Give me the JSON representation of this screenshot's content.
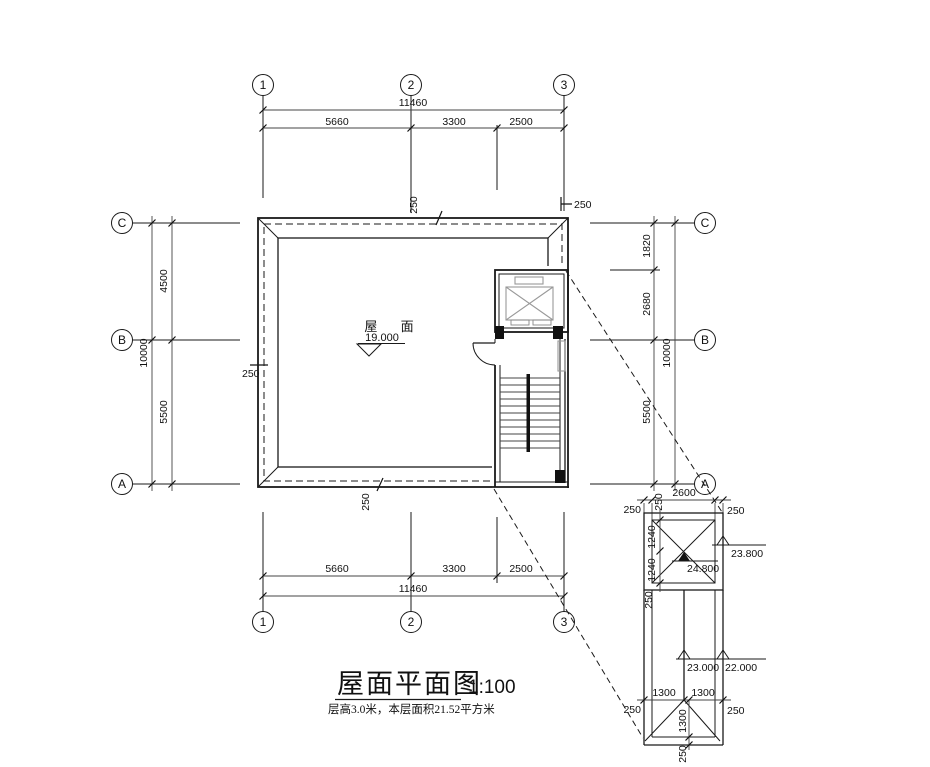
{
  "title_block": {
    "title": "屋面平面图",
    "scale": "1:100",
    "note": "层高3.0米，本层面积21.52平方米"
  },
  "roof": {
    "label": "屋 面",
    "level": "19.000"
  },
  "grid_bubbles": {
    "top": [
      "1",
      "2",
      "3"
    ],
    "bottom": [
      "1",
      "2",
      "3"
    ],
    "left": [
      "C",
      "B",
      "A"
    ],
    "right": [
      "C",
      "B",
      "A"
    ]
  },
  "dimensions": {
    "top": {
      "overall": "11460",
      "seg1": "5660",
      "seg2": "3300",
      "seg3": "2500",
      "parapet": "250",
      "edge": "250"
    },
    "bottom": {
      "overall": "11460",
      "seg1": "5660",
      "seg2": "3300",
      "seg3": "2500",
      "parapet": "250"
    },
    "left": {
      "overall": "10000",
      "seg1": "4500",
      "seg2": "5500",
      "parapet": "250"
    },
    "right": {
      "overall": "10000",
      "seg1": "1820",
      "seg2": "2680",
      "seg3": "5500"
    }
  },
  "detail": {
    "top": {
      "left": "250",
      "overall": "2600",
      "right": "250",
      "parapet": "250"
    },
    "side": {
      "seg1": "1240",
      "seg2": "1240",
      "parapet": "250"
    },
    "levels": {
      "apex": "24.800",
      "eave_upper": "23.800",
      "ridge": "23.000",
      "eave_lower": "22.000"
    },
    "bottom": {
      "seg1": "1300",
      "seg2": "1300",
      "left": "250",
      "right": "250",
      "ridge": "1300",
      "parapet": "250"
    }
  }
}
